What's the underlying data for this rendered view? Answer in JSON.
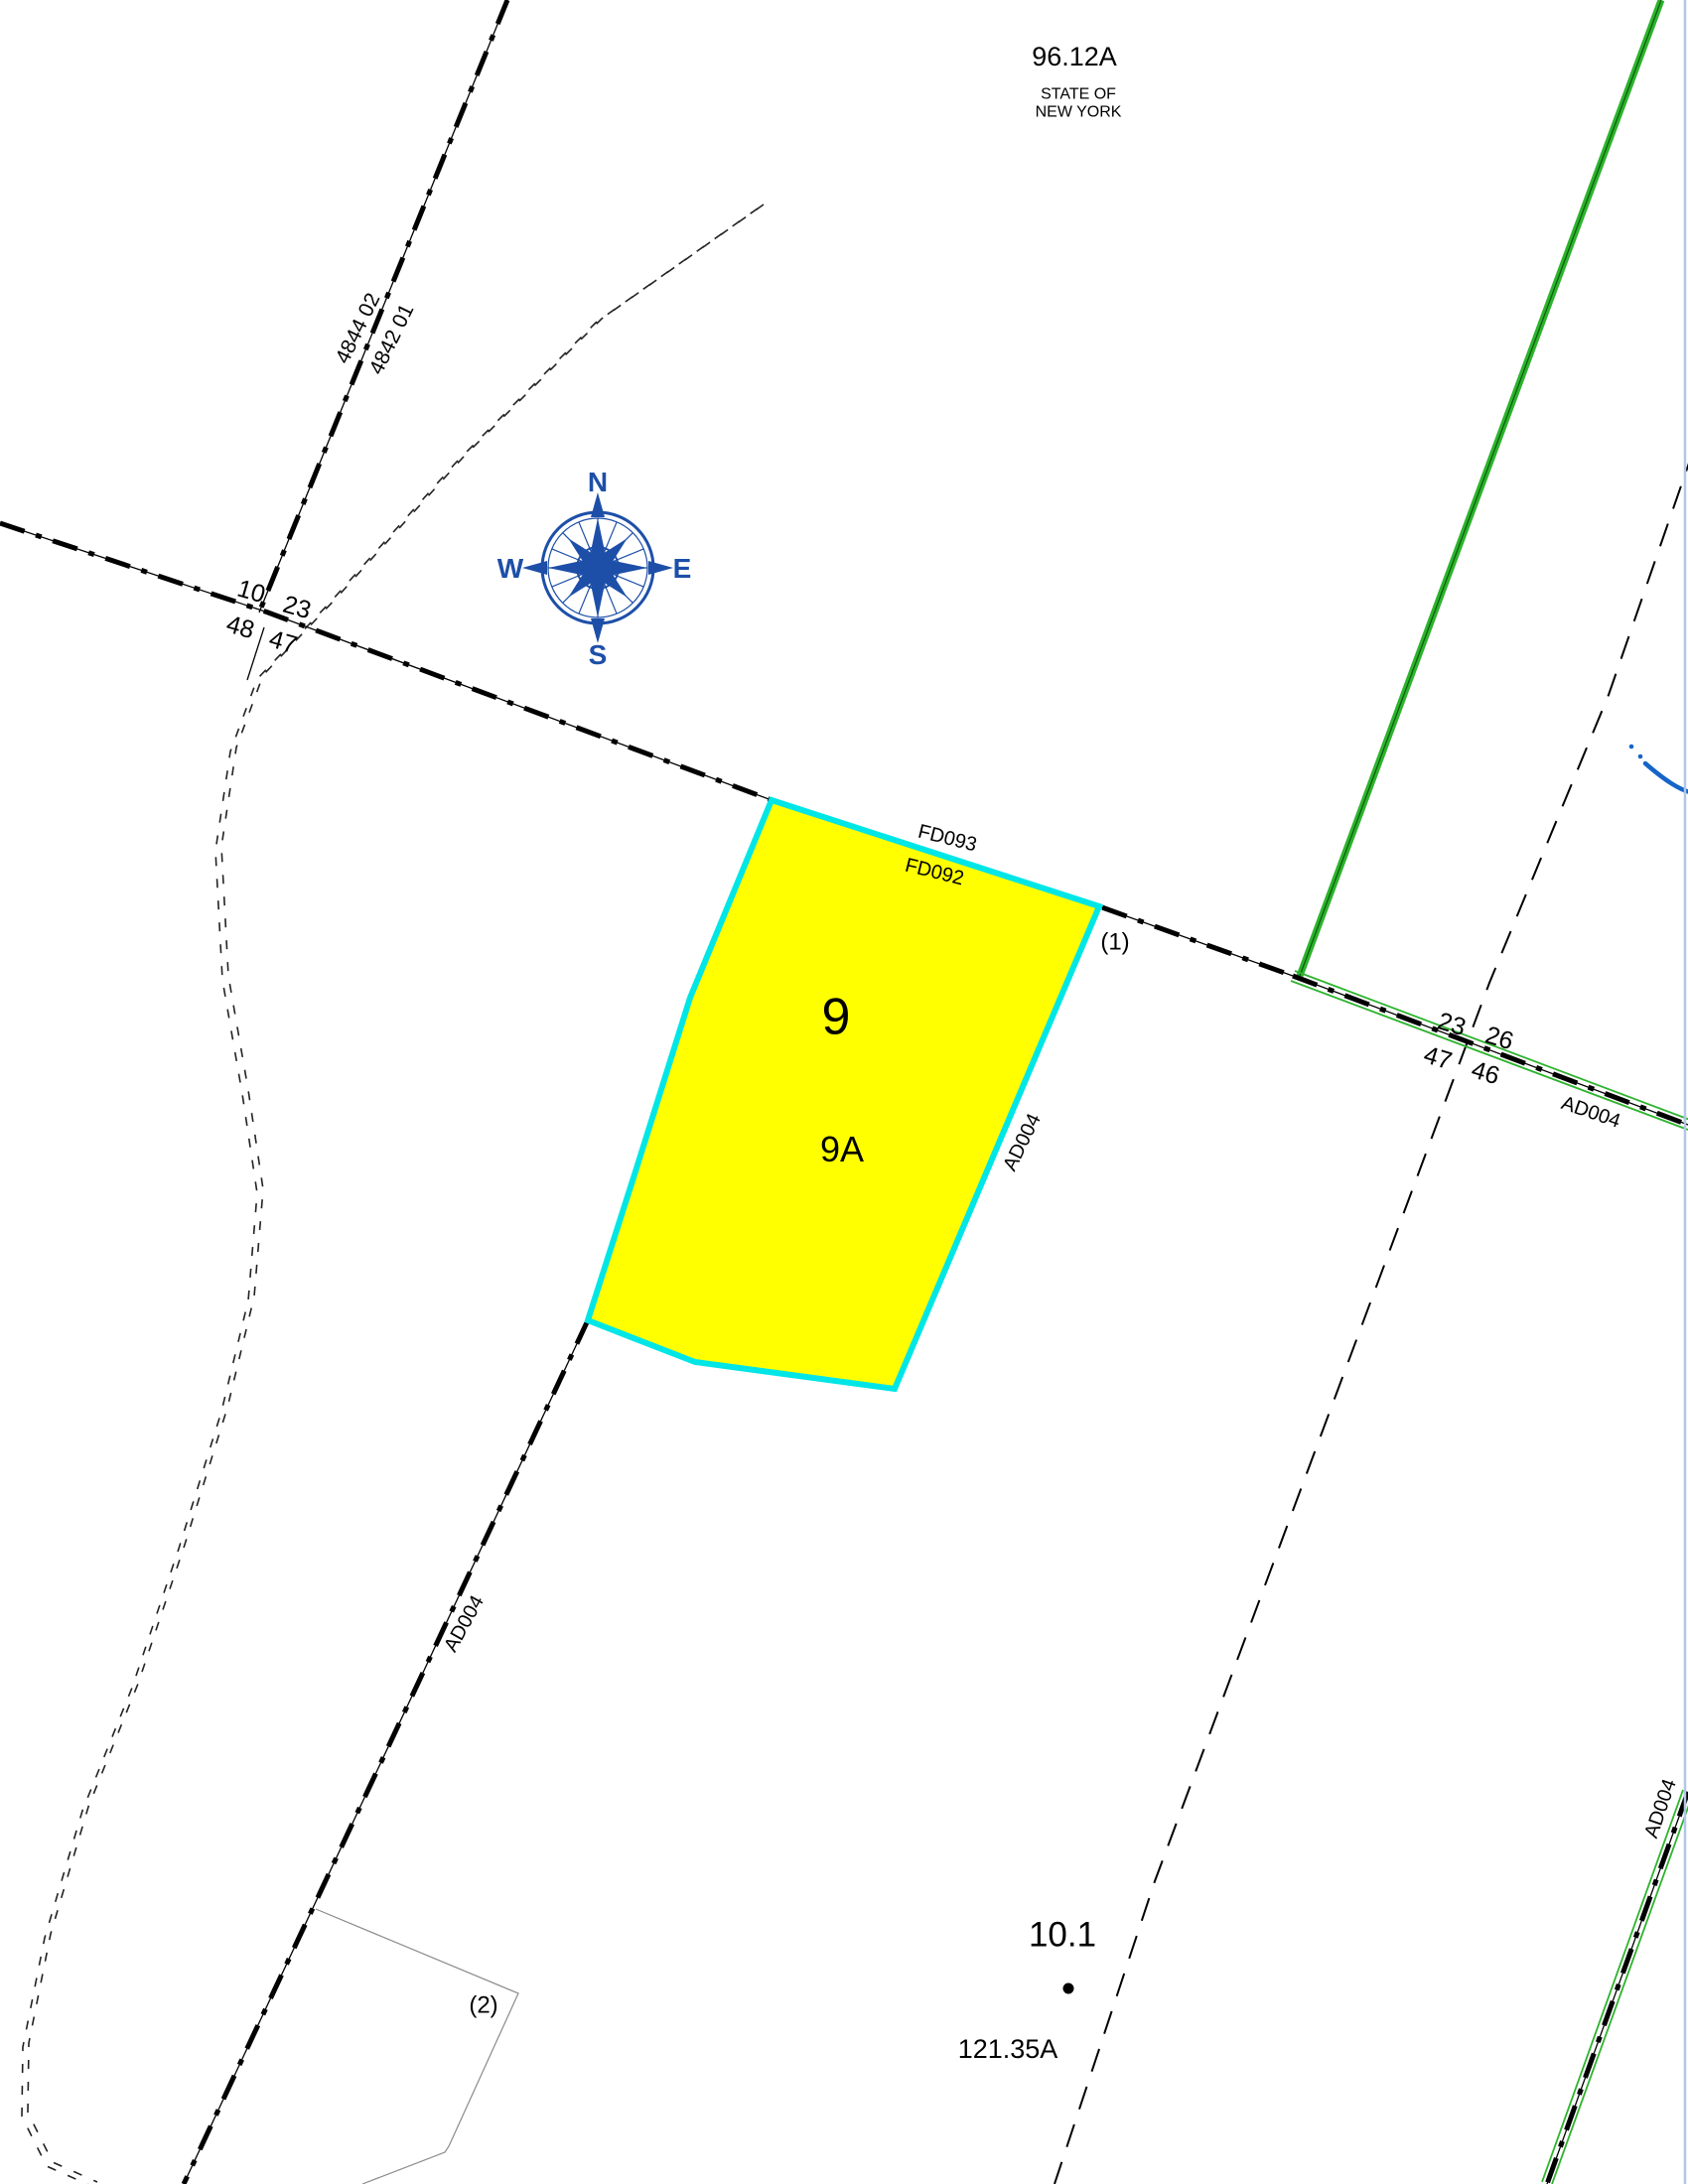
{
  "parcels": {
    "state": {
      "acreage": "96.12A",
      "owner_line1": "STATE OF",
      "owner_line2": "NEW YORK"
    },
    "selected": {
      "id": "9",
      "sub_id": "9A",
      "note": "(1)"
    },
    "south": {
      "id": "10.1",
      "acreage": "121.35A",
      "note": "(2)"
    }
  },
  "roads": {
    "ad004": "AD004",
    "fd093": "FD093",
    "fd092": "FD092"
  },
  "junction_left": {
    "nw": "10",
    "ne": "23",
    "sw": "48",
    "se": "47"
  },
  "junction_right": {
    "nw": "23",
    "ne": "26",
    "sw": "47",
    "se": "46"
  },
  "boundary": {
    "swis_left": "4844 02",
    "swis_right": "4842 01"
  },
  "compass": {
    "north": "N",
    "south": "S",
    "east": "E",
    "west": "W"
  },
  "colors": {
    "parcel_fill": "#ffff00",
    "parcel_highlight": "#00e6e6",
    "road_green": "#2db32d",
    "compass_blue": "#1d4fa8",
    "stream_blue": "#1565c8",
    "neatline_blue": "#b2c6e8"
  }
}
